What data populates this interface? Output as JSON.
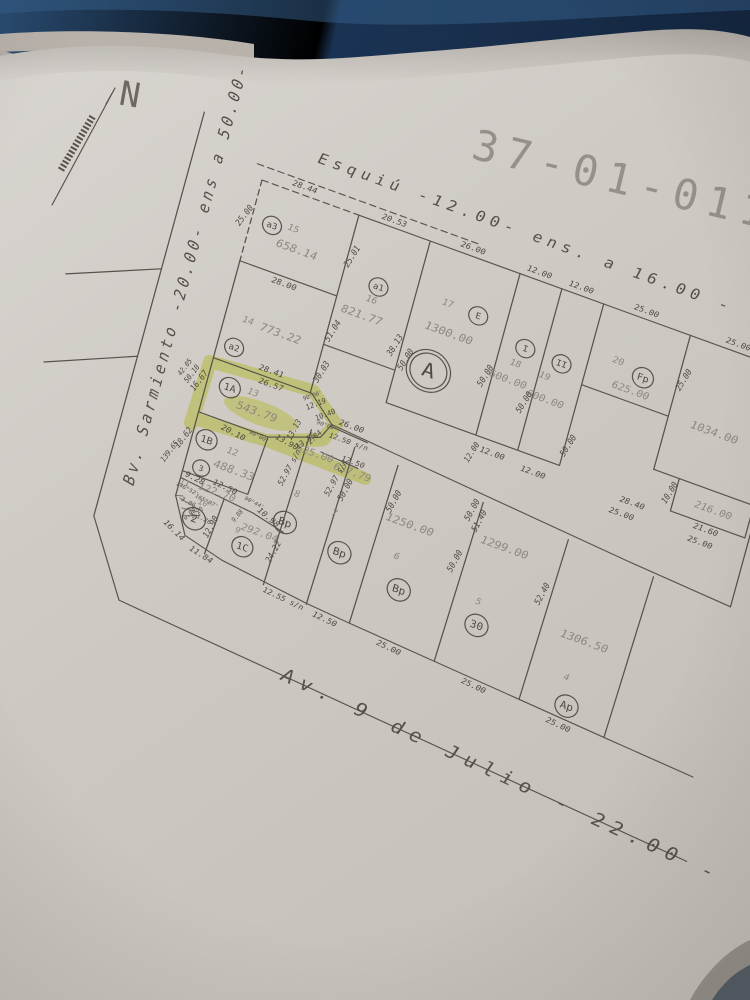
{
  "title": "37-01-011",
  "north_label": "N",
  "streets": {
    "top": "Esquiú  -12.00-  ens. a 16.00 -",
    "left": "Bv. Sarmiento  -20.00-  ens  a  50.00-",
    "bottom": "Av.  9  de  Julio  -  22.00  -"
  },
  "colors": {
    "background_table": "#16293f",
    "paper": "#d0cbc5",
    "ink": "#57524b",
    "area_text": "#8e887d",
    "highlight": "#dde94e"
  },
  "highlighted_parcel": {
    "number": "13",
    "circle": "1A",
    "area": "543.79"
  },
  "map": {
    "circles": [
      {
        "t": "a3",
        "x": 20,
        "y": 40,
        "r": 9
      },
      {
        "t": "a1",
        "x": 130,
        "y": 62,
        "r": 9
      },
      {
        "t": "a2",
        "x": 16,
        "y": 170,
        "r": 9
      },
      {
        "t": "E",
        "x": 226,
        "y": 55,
        "r": 9
      },
      {
        "t": "I",
        "x": 276,
        "y": 70,
        "r": 9
      },
      {
        "t": "II",
        "x": 312,
        "y": 72,
        "r": 9
      },
      {
        "t": "Fp",
        "x": 388,
        "y": 57,
        "r": 10
      },
      {
        "t": "1A",
        "x": 22,
        "y": 210,
        "r": 10
      },
      {
        "t": "1B",
        "x": 14,
        "y": 268,
        "r": 10
      },
      {
        "t": "3",
        "x": 16,
        "y": 297,
        "r": 8
      },
      {
        "t": "2",
        "x": 22,
        "y": 348,
        "r": 11
      },
      {
        "t": "1C",
        "x": 72,
        "y": 358,
        "r": 10
      },
      {
        "t": "Bp",
        "x": 104,
        "y": 320,
        "r": 11
      },
      {
        "t": "Bp",
        "x": 160,
        "y": 330,
        "r": 11
      },
      {
        "t": "Bp",
        "x": 222,
        "y": 345,
        "r": 11
      },
      {
        "t": "30",
        "x": 300,
        "y": 352,
        "r": 11
      },
      {
        "t": "Ap",
        "x": 400,
        "y": 398,
        "r": 11
      },
      {
        "t": "A",
        "x": 195,
        "y": 125,
        "r": 21,
        "d": 2
      }
    ],
    "labels": [
      {
        "t": "658.14",
        "x": 48,
        "y": 55,
        "c": "area",
        "s": 11
      },
      {
        "t": "821.77",
        "x": 122,
        "y": 95,
        "c": "area",
        "s": 11
      },
      {
        "t": "1300.00",
        "x": 204,
        "y": 82,
        "c": "area",
        "s": 11
      },
      {
        "t": "600.00",
        "x": 268,
        "y": 106,
        "c": "area",
        "s": 10
      },
      {
        "t": "600.00",
        "x": 306,
        "y": 112,
        "c": "area",
        "s": 10
      },
      {
        "t": "625.00",
        "x": 380,
        "y": 74,
        "c": "area",
        "s": 10
      },
      {
        "t": "1034.00",
        "x": 465,
        "y": 85,
        "c": "area",
        "s": 11
      },
      {
        "t": "216.00",
        "x": 483,
        "y": 160,
        "c": "area",
        "s": 10
      },
      {
        "t": "773.22",
        "x": 54,
        "y": 141,
        "c": "area",
        "s": 11
      },
      {
        "t": "543.79",
        "x": 52,
        "y": 224,
        "c": "area",
        "s": 11
      },
      {
        "t": "488.33",
        "x": 46,
        "y": 288,
        "c": "area",
        "s": 11
      },
      {
        "t": "122.70",
        "x": 36,
        "y": 315,
        "c": "area",
        "s": 10
      },
      {
        "t": "292.04",
        "x": 84,
        "y": 339,
        "c": "area",
        "s": 10
      },
      {
        "t": "625.00",
        "x": 114,
        "y": 244,
        "c": "area",
        "s": 10
      },
      {
        "t": "637.79",
        "x": 152,
        "y": 249,
        "c": "area",
        "s": 10
      },
      {
        "t": "1250.00",
        "x": 216,
        "y": 279,
        "c": "area",
        "s": 11
      },
      {
        "t": "1299.00",
        "x": 306,
        "y": 268,
        "c": "area",
        "s": 11
      },
      {
        "t": "1306.50",
        "x": 400,
        "y": 330,
        "c": "area",
        "s": 11
      },
      {
        "t": "15",
        "x": 40,
        "y": 36,
        "c": "num",
        "s": 9
      },
      {
        "t": "16",
        "x": 127,
        "y": 77,
        "c": "num",
        "s": 9
      },
      {
        "t": "17",
        "x": 196,
        "y": 54,
        "c": "num",
        "s": 9
      },
      {
        "t": "18",
        "x": 271,
        "y": 88,
        "c": "num",
        "s": 9
      },
      {
        "t": "19",
        "x": 300,
        "y": 90,
        "c": "num",
        "s": 9
      },
      {
        "t": "20",
        "x": 362,
        "y": 50,
        "c": "num",
        "s": 9
      },
      {
        "t": "14",
        "x": 22,
        "y": 140,
        "c": "num",
        "s": 9
      },
      {
        "t": "13",
        "x": 44,
        "y": 207,
        "c": "num",
        "s": 9
      },
      {
        "t": "12",
        "x": 40,
        "y": 271,
        "c": "num",
        "s": 9
      },
      {
        "t": "11",
        "x": 5,
        "y": 317,
        "c": "num",
        "s": 8
      },
      {
        "t": "10",
        "x": 26,
        "y": 330,
        "c": "num",
        "s": 8
      },
      {
        "t": "9",
        "x": 64,
        "y": 344,
        "c": "num",
        "s": 8
      },
      {
        "t": "8",
        "x": 108,
        "y": 289,
        "c": "num",
        "s": 9
      },
      {
        "t": "7",
        "x": 146,
        "y": 294,
        "c": "num",
        "s": 9
      },
      {
        "t": "6",
        "x": 212,
        "y": 314,
        "c": "num",
        "s": 9
      },
      {
        "t": "5",
        "x": 296,
        "y": 329,
        "c": "num",
        "s": 9
      },
      {
        "t": "4",
        "x": 393,
        "y": 371,
        "c": "num",
        "s": 9
      },
      {
        "t": "28.00",
        "x": 45,
        "y": 92,
        "r": 0,
        "c": "dim",
        "s": 8
      },
      {
        "t": "25.01",
        "x": 99,
        "y": 42,
        "r": -75,
        "c": "dim",
        "s": 8
      },
      {
        "t": "25.00",
        "x": -7,
        "y": 40,
        "r": -70,
        "c": "dim",
        "s": 8
      },
      {
        "t": "28.44",
        "x": 40,
        "y": -8,
        "r": 0,
        "c": "dim",
        "s": 8
      },
      {
        "t": "20.53",
        "x": 128,
        "y": -7,
        "r": 0,
        "c": "dim",
        "s": 8
      },
      {
        "t": "26.00",
        "x": 205,
        "y": -8,
        "r": 0,
        "c": "dim",
        "s": 8
      },
      {
        "t": "12.00",
        "x": 270,
        "y": -8,
        "r": 0,
        "c": "dim",
        "s": 8
      },
      {
        "t": "12.00",
        "x": 311,
        "y": -8,
        "r": 0,
        "c": "dim",
        "s": 8
      },
      {
        "t": "25.00",
        "x": 375,
        "y": -8,
        "r": 0,
        "c": "dim",
        "s": 8
      },
      {
        "t": "25.00",
        "x": 465,
        "y": -8,
        "r": 0,
        "c": "dim",
        "s": 8
      },
      {
        "t": "51.04",
        "x": 100,
        "y": 120,
        "r": -75,
        "c": "dim",
        "s": 8
      },
      {
        "t": "30.03",
        "x": 100,
        "y": 163,
        "r": -75,
        "c": "dim",
        "s": 8
      },
      {
        "t": "38.13",
        "x": 159,
        "y": 112,
        "r": -75,
        "c": "dim",
        "s": 8
      },
      {
        "t": "50.00",
        "x": 172,
        "y": 122,
        "r": -75,
        "c": "dim",
        "s": 8
      },
      {
        "t": "50.00",
        "x": 247,
        "y": 110,
        "r": -75,
        "c": "dim",
        "s": 8
      },
      {
        "t": "50.00",
        "x": 288,
        "y": 122,
        "r": -75,
        "c": "dim",
        "s": 8
      },
      {
        "t": "50.00",
        "x": 338,
        "y": 148,
        "r": -75,
        "c": "dim",
        "s": 8
      },
      {
        "t": "25.00",
        "x": 425,
        "y": 45,
        "r": -75,
        "c": "dim",
        "s": 8
      },
      {
        "t": "50.00",
        "x": 527,
        "y": 60,
        "r": -75,
        "c": "dim",
        "s": 8
      },
      {
        "t": "10.00",
        "x": 440,
        "y": 158,
        "r": -75,
        "c": "dim",
        "s": 8
      },
      {
        "t": "21.60",
        "x": 481,
        "y": 181,
        "r": 0,
        "c": "dim",
        "s": 8
      },
      {
        "t": "25.00",
        "x": 479,
        "y": 195,
        "r": 0,
        "c": "dim",
        "s": 8
      },
      {
        "t": "28.40",
        "x": 409,
        "y": 181,
        "r": 0,
        "c": "dim",
        "s": 8
      },
      {
        "t": "25.00",
        "x": 402,
        "y": 195,
        "r": 0,
        "c": "dim",
        "s": 8
      },
      {
        "t": "28.41",
        "x": 55,
        "y": 180,
        "r": 0,
        "c": "dim",
        "s": 8
      },
      {
        "t": "26.57",
        "x": 58,
        "y": 193,
        "r": 0,
        "c": "dim",
        "s": 8
      },
      {
        "t": "16.67",
        "x": -7,
        "y": 214,
        "r": -70,
        "c": "dim",
        "s": 8
      },
      {
        "t": "50.10",
        "x": -15,
        "y": 210,
        "r": -70,
        "c": "dim",
        "s": 7
      },
      {
        "t": "42.05",
        "x": -23,
        "y": 206,
        "r": -70,
        "c": "dim",
        "s": 6.5
      },
      {
        "t": "139.65",
        "x": -16,
        "y": 292,
        "r": -70,
        "c": "dim",
        "s": 7
      },
      {
        "t": "20.10",
        "x": 36,
        "y": 252,
        "r": 8,
        "c": "dim",
        "s": 8
      },
      {
        "t": "12.19",
        "x": 103,
        "y": 196,
        "r": -42,
        "c": "dim",
        "s": 7
      },
      {
        "t": "10.40",
        "x": 114,
        "y": 203,
        "r": -42,
        "c": "dim",
        "s": 7
      },
      {
        "t": "2.84",
        "x": 110,
        "y": 228,
        "r": -62,
        "c": "dim",
        "s": 7
      },
      {
        "t": "13.90",
        "x": 86,
        "y": 243,
        "r": 10,
        "c": "dim",
        "s": 7.5
      },
      {
        "t": "13.55",
        "x": 103,
        "y": 235,
        "r": -55,
        "c": "dim",
        "s": 7.5
      },
      {
        "t": "12.50 s/n",
        "x": 141,
        "y": 221,
        "r": 0,
        "c": "dim",
        "s": 7
      },
      {
        "t": "12.50",
        "x": 150,
        "y": 239,
        "r": 0,
        "c": "dim",
        "s": 7.5
      },
      {
        "t": "18.62",
        "x": -7,
        "y": 274,
        "r": -70,
        "c": "dim",
        "s": 8
      },
      {
        "t": "9.28",
        "x": 13,
        "y": 309,
        "r": 8,
        "c": "dim",
        "s": 8
      },
      {
        "t": "12.50",
        "x": 42,
        "y": 307,
        "r": 6,
        "c": "dim",
        "s": 8
      },
      {
        "t": "10.98",
        "x": 88,
        "y": 321,
        "r": 22,
        "c": "dim",
        "s": 8
      },
      {
        "t": "24.22",
        "x": 101,
        "y": 352,
        "r": -78,
        "c": "dim",
        "s": 8
      },
      {
        "t": "12.90",
        "x": 39,
        "y": 350,
        "r": -78,
        "c": "dim",
        "s": 8
      },
      {
        "t": "11.84",
        "x": 37,
        "y": 380,
        "r": 14,
        "c": "dim",
        "s": 8
      },
      {
        "t": "16.14",
        "x": 7,
        "y": 366,
        "r": 28,
        "c": "dim",
        "s": 8
      },
      {
        "t": "12.55 s/n",
        "x": 121,
        "y": 394,
        "r": 6,
        "c": "dim",
        "s": 7.5
      },
      {
        "t": "12.50",
        "x": 163,
        "y": 399,
        "r": 6,
        "c": "dim",
        "s": 8
      },
      {
        "t": "25.00",
        "x": 227,
        "y": 404,
        "r": 6,
        "c": "dim",
        "s": 8
      },
      {
        "t": "25.00",
        "x": 312,
        "y": 411,
        "r": 6,
        "c": "dim",
        "s": 8
      },
      {
        "t": "25.00",
        "x": 397,
        "y": 419,
        "r": 6,
        "c": "dim",
        "s": 8
      },
      {
        "t": "52.97 s/n",
        "x": 95,
        "y": 266,
        "r": -78,
        "c": "dim",
        "s": 7.5
      },
      {
        "t": "52.97 s/n",
        "x": 139,
        "y": 260,
        "r": -78,
        "c": "dim",
        "s": 7.5
      },
      {
        "t": "50.00",
        "x": 150,
        "y": 268,
        "r": -78,
        "c": "dim",
        "s": 8
      },
      {
        "t": "13.13",
        "x": 90,
        "y": 228,
        "r": -78,
        "c": "dim",
        "s": 7.5
      },
      {
        "t": "50.00",
        "x": 196,
        "y": 262,
        "r": -78,
        "c": "dim",
        "s": 8
      },
      {
        "t": "50.00",
        "x": 265,
        "y": 298,
        "r": -78,
        "c": "dim",
        "s": 8
      },
      {
        "t": "50.00",
        "x": 268,
        "y": 243,
        "r": -78,
        "c": "dim",
        "s": 8
      },
      {
        "t": "51.40",
        "x": 277,
        "y": 251,
        "r": -78,
        "c": "dim",
        "s": 8
      },
      {
        "t": "52.40",
        "x": 351,
        "y": 299,
        "r": -78,
        "c": "dim",
        "s": 8
      },
      {
        "t": "12.00",
        "x": 272,
        "y": 182,
        "r": 0,
        "c": "dim",
        "s": 8
      },
      {
        "t": "12.00",
        "x": 313,
        "y": 186,
        "r": 0,
        "c": "dim",
        "s": 8
      },
      {
        "t": "12.00",
        "x": 254,
        "y": 188,
        "r": -75,
        "c": "dim",
        "s": 7.5
      },
      {
        "t": "26.00",
        "x": 140,
        "y": 205,
        "r": 0,
        "c": "dim",
        "s": 8
      },
      {
        "t": "3.06",
        "x": 13,
        "y": 334,
        "r": 8,
        "c": "tiny",
        "s": 6
      },
      {
        "t": "2.20",
        "x": 23,
        "y": 341,
        "r": -58,
        "c": "tiny",
        "s": 6
      },
      {
        "t": "1.26",
        "x": 31,
        "y": 345,
        "r": 8,
        "c": "tiny",
        "s": 6
      },
      {
        "t": "0.90",
        "x": 17,
        "y": 345,
        "r": -58,
        "c": "tiny",
        "s": 6
      },
      {
        "t": "9.88",
        "x": 60,
        "y": 330,
        "r": -68,
        "c": "tiny",
        "s": 6
      },
      {
        "t": "146°52'",
        "x": 9,
        "y": 322,
        "r": 8,
        "c": "tiny",
        "s": 5.5
      },
      {
        "t": "165°07'",
        "x": 29,
        "y": 327,
        "r": 8,
        "c": "tiny",
        "s": 5.5
      },
      {
        "t": "90°44'",
        "x": 72,
        "y": 312,
        "r": 8,
        "c": "tiny",
        "s": 5.5
      },
      {
        "t": "90°00'",
        "x": 118,
        "y": 213,
        "r": 0,
        "c": "tiny",
        "s": 5.5
      },
      {
        "t": "90°00'",
        "x": 98,
        "y": 189,
        "r": -40,
        "c": "tiny",
        "s": 5.5
      },
      {
        "t": "90°00'",
        "x": 60,
        "y": 247,
        "r": 8,
        "c": "tiny",
        "s": 5.5
      }
    ]
  }
}
